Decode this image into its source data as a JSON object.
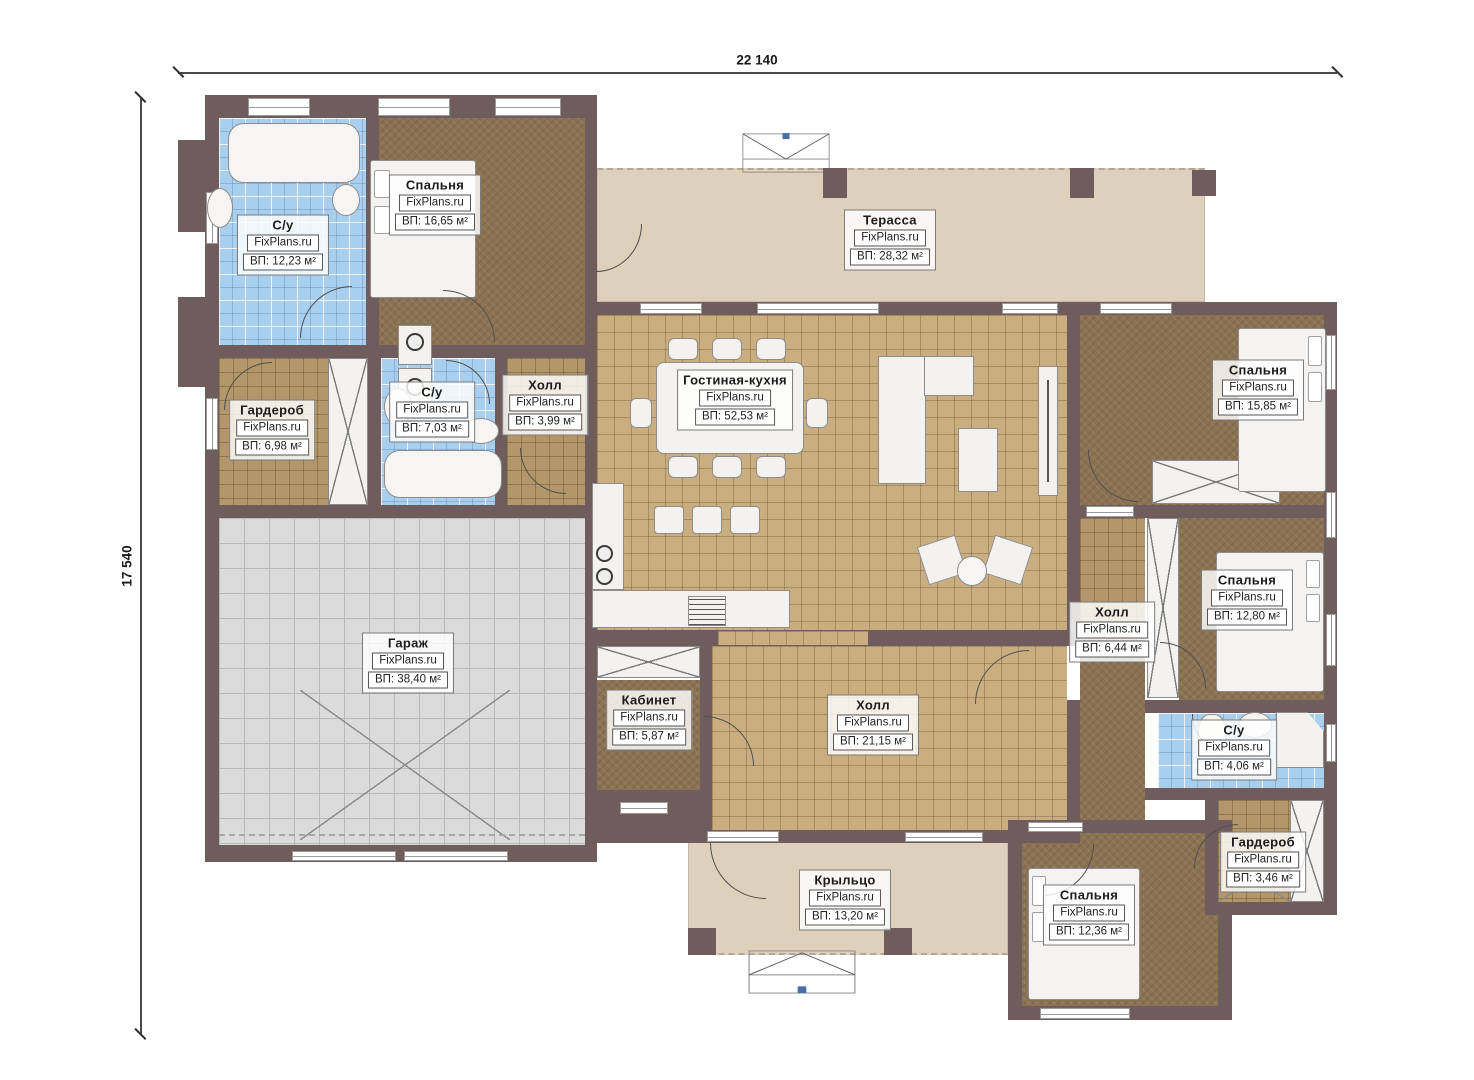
{
  "dimensions": {
    "width": "22 140",
    "height": "17 540"
  },
  "brand": "FixPlans.ru",
  "colors": {
    "wall": "#6F5D5D",
    "bathroom_tile": "#A9CFEF",
    "bedroom_floor": "#8B7252",
    "parquet_floor": "#B3976A",
    "living_tile": "#CBAE80",
    "terrace_floor": "#DED1BC",
    "garage_floor": "#DBDBDB",
    "canopy_dot": "#4A6FA5"
  },
  "rooms": [
    {
      "id": "bathroom-1",
      "name": "С/у",
      "brand": "FixPlans.ru",
      "area": "ВП: 12,23 м²"
    },
    {
      "id": "bedroom-1",
      "name": "Спальня",
      "brand": "FixPlans.ru",
      "area": "ВП: 16,65 м²"
    },
    {
      "id": "terrace",
      "name": "Терасса",
      "brand": "FixPlans.ru",
      "area": "ВП: 28,32 м²"
    },
    {
      "id": "wardrobe-1",
      "name": "Гардероб",
      "brand": "FixPlans.ru",
      "area": "ВП: 6,98 м²"
    },
    {
      "id": "bathroom-2",
      "name": "С/у",
      "brand": "FixPlans.ru",
      "area": "ВП: 7,03 м²"
    },
    {
      "id": "hall-1",
      "name": "Холл",
      "brand": "FixPlans.ru",
      "area": "ВП: 3,99 м²"
    },
    {
      "id": "living-kitchen",
      "name": "Гостиная-кухня",
      "brand": "FixPlans.ru",
      "area": "ВП: 52,53 м²"
    },
    {
      "id": "bedroom-2",
      "name": "Спальня",
      "brand": "FixPlans.ru",
      "area": "ВП: 15,85 м²"
    },
    {
      "id": "hall-2",
      "name": "Холл",
      "brand": "FixPlans.ru",
      "area": "ВП: 6,44 м²"
    },
    {
      "id": "bedroom-3",
      "name": "Спальня",
      "brand": "FixPlans.ru",
      "area": "ВП: 12,80 м²"
    },
    {
      "id": "garage",
      "name": "Гараж",
      "brand": "FixPlans.ru",
      "area": "ВП: 38,40 м²"
    },
    {
      "id": "office",
      "name": "Кабинет",
      "brand": "FixPlans.ru",
      "area": "ВП: 5,87 м²"
    },
    {
      "id": "hall-3",
      "name": "Холл",
      "brand": "FixPlans.ru",
      "area": "ВП: 21,15 м²"
    },
    {
      "id": "bathroom-3",
      "name": "С/у",
      "brand": "FixPlans.ru",
      "area": "ВП: 4,06 м²"
    },
    {
      "id": "wardrobe-2",
      "name": "Гардероб",
      "brand": "FixPlans.ru",
      "area": "ВП: 3,46 м²"
    },
    {
      "id": "porch",
      "name": "Крыльцо",
      "brand": "FixPlans.ru",
      "area": "ВП: 13,20 м²"
    },
    {
      "id": "bedroom-4",
      "name": "Спальня",
      "brand": "FixPlans.ru",
      "area": "ВП: 12,36 м²"
    }
  ]
}
